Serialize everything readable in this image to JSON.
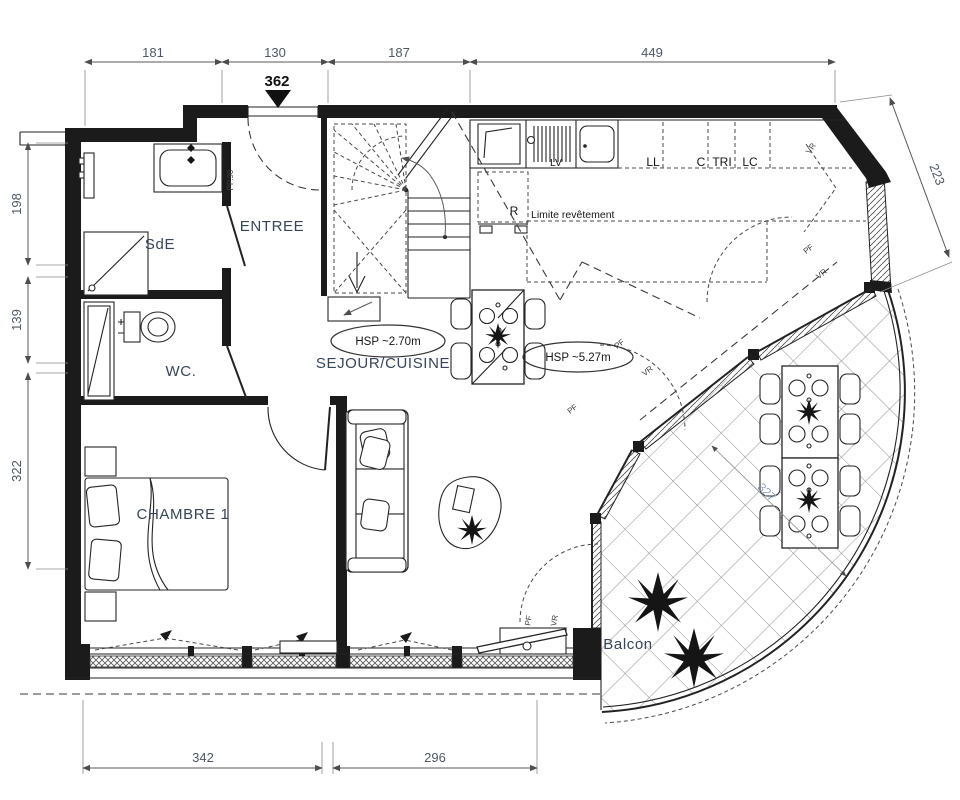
{
  "dimensions": {
    "top": {
      "seg1": "181",
      "seg2": "130",
      "seg3": "187",
      "seg4": "449"
    },
    "level": "362",
    "left": {
      "seg1": "198",
      "seg2": "139",
      "seg3": "322"
    },
    "right": {
      "seg1": "223"
    },
    "bottom": {
      "seg1": "342",
      "seg2": "296"
    },
    "balcony": {
      "seg1": "327"
    }
  },
  "rooms": {
    "sde": "SdE",
    "wc": "WC.",
    "entree": "ENTREE",
    "chambre1": "CHAMBRE 1",
    "sejour_cuisine": "SEJOUR/CUISINE",
    "balcon": "Balcon"
  },
  "annotations": {
    "hsp_sejour": "HSP ~2.70m",
    "hsp_haut": "HSP ~5.27m",
    "limite_revetement": "Limite revêtement",
    "porte_palier": "PP.90"
  },
  "kitchen_labels": {
    "lv": "LV",
    "ll": "LL",
    "c": "C",
    "tri": "TRI",
    "lc": "LC",
    "r": "R"
  },
  "window_labels": {
    "pf": "PF",
    "vr": "VR"
  },
  "colors": {
    "wall": "#1b1b1b",
    "room_label": "#36455c",
    "dimension_text": "#4d5866",
    "balcony_dimension": "#8fa0c6",
    "background": "#ffffff"
  }
}
